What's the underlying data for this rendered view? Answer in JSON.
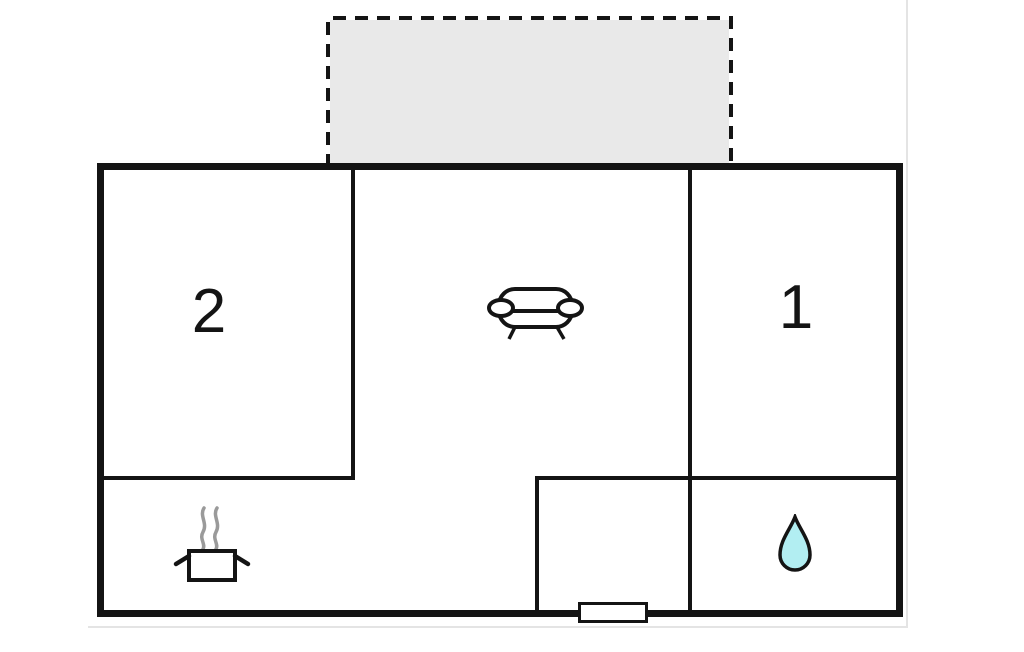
{
  "plan": {
    "type": "floor-plan",
    "colors": {
      "background": "#ffffff",
      "wall": "#141414",
      "terrace_fill": "#e9e9e9",
      "water_drop_fill": "#b2eef2",
      "steam": "#9a9a9a"
    },
    "terrace": {
      "name": "terrace",
      "style": "dashed-outline"
    },
    "rooms": {
      "bedroom_left": {
        "label": "2"
      },
      "bedroom_right": {
        "label": "1"
      },
      "living_room": {
        "icon": "sofa-icon"
      },
      "kitchen": {
        "icon": "cooking-pot-icon"
      },
      "bathroom": {
        "icon": "water-drop-icon"
      },
      "entrance_hall": {
        "feature": "entrance-door"
      }
    }
  }
}
